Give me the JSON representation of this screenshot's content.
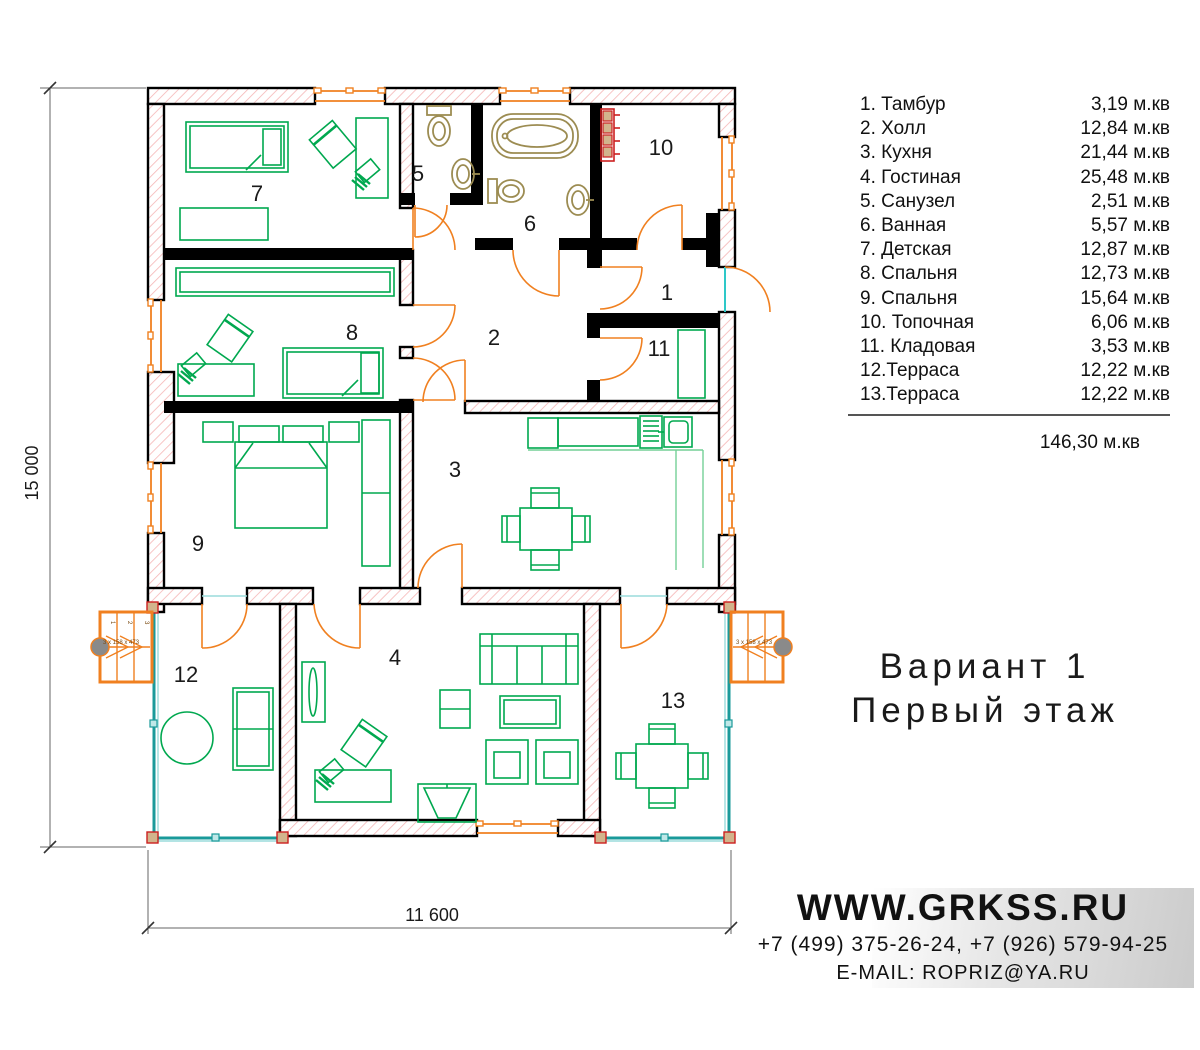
{
  "legend": {
    "items": [
      {
        "label": "1. Тамбур",
        "area": "3,19 м.кв"
      },
      {
        "label": "2. Холл",
        "area": "12,84 м.кв"
      },
      {
        "label": "3. Кухня",
        "area": "21,44 м.кв"
      },
      {
        "label": "4. Гостиная",
        "area": "25,48 м.кв"
      },
      {
        "label": "5. Санузел",
        "area": "2,51 м.кв"
      },
      {
        "label": "6. Ванная",
        "area": "5,57 м.кв"
      },
      {
        "label": "7. Детская",
        "area": "12,87 м.кв"
      },
      {
        "label": "8. Спальня",
        "area": "12,73 м.кв"
      },
      {
        "label": "9. Спальня",
        "area": "15,64 м.кв"
      },
      {
        "label": "10. Топочная",
        "area": "6,06 м.кв"
      },
      {
        "label": "11. Кладовая",
        "area": "3,53 м.кв"
      },
      {
        "label": "12.Терраса",
        "area": "12,22 м.кв"
      },
      {
        "label": "13.Терраса",
        "area": "12,22 м.кв"
      }
    ],
    "total": "146,30 м.кв"
  },
  "title": {
    "line1": "Вариант 1",
    "line2": "Первый этаж"
  },
  "contacts": {
    "website": "WWW.GRKSS.RU",
    "phones": "+7 (499) 375-26-24, +7 (926) 579-94-25",
    "email": "E-MAIL: ROPRIZ@YA.RU"
  },
  "dimensions": {
    "height": "15 000",
    "width": "11 600"
  },
  "plan": {
    "rooms": [
      "1",
      "2",
      "3",
      "4",
      "5",
      "6",
      "7",
      "8",
      "9",
      "10",
      "11",
      "12",
      "13"
    ],
    "stairs_note": "3 x 158 x 473",
    "stair_steps": [
      "1",
      "2",
      "3"
    ]
  },
  "colors": {
    "wall": "#000000",
    "hatch": "#f5b5b5",
    "furniture": "#00a84f",
    "doors": "#f08020",
    "sanitary": "#9c8c52",
    "terrace": "#1a9a9a",
    "radiator": "#cc2020"
  }
}
